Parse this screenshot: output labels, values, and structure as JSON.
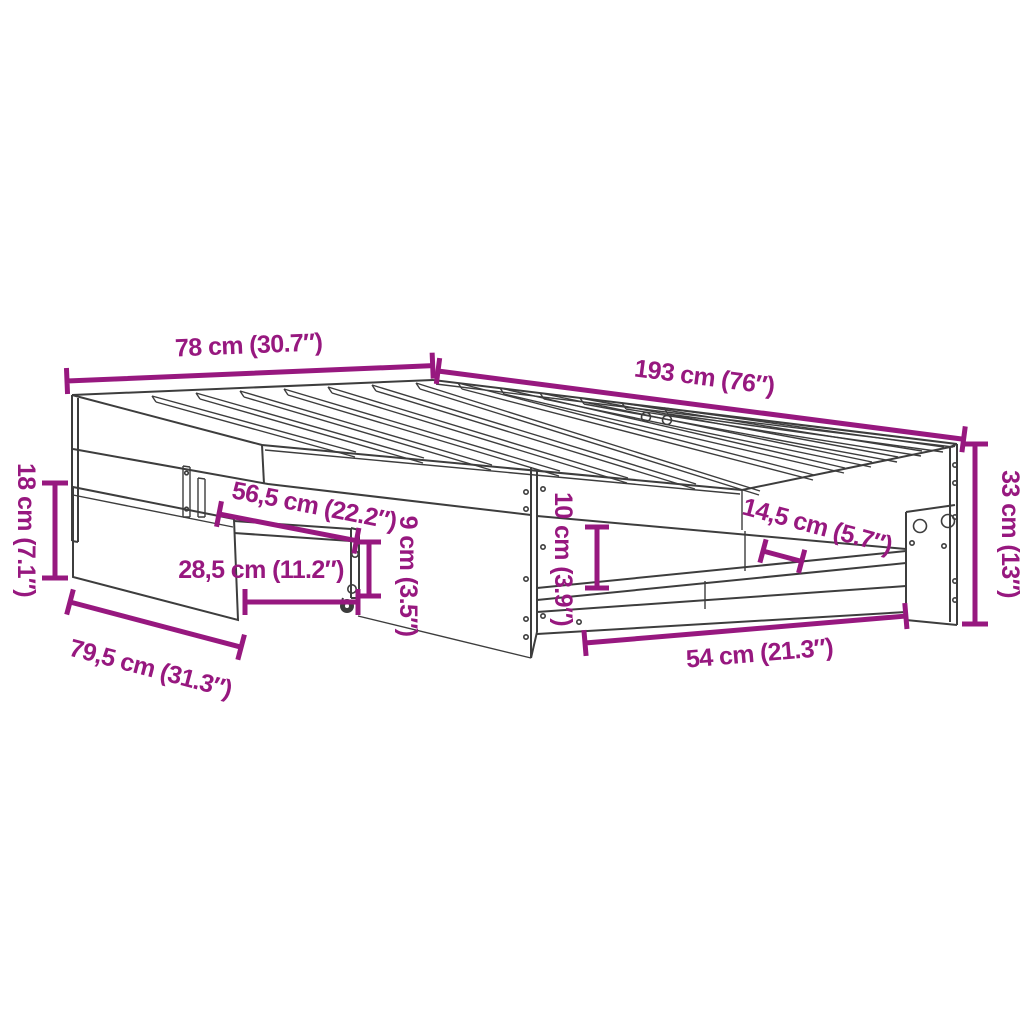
{
  "title": "Bed frame dimension diagram",
  "colors": {
    "dimension": "#97187f",
    "drawing": "#3d3d3d",
    "background": "#ffffff"
  },
  "dimensions": [
    {
      "id": "head-width",
      "label": "78 cm (30.7″)"
    },
    {
      "id": "frame-length",
      "label": "193 cm (76″)"
    },
    {
      "id": "frame-height",
      "label": "33 cm (13″)"
    },
    {
      "id": "pullout-panel-height",
      "label": "18 cm (7.1″)"
    },
    {
      "id": "pullout-depth",
      "label": "79,5 cm (31.3″)"
    },
    {
      "id": "pullout-rail-length",
      "label": "56,5 cm (22.2″)"
    },
    {
      "id": "pullout-front-width",
      "label": "28,5 cm (11.2″)"
    },
    {
      "id": "pullout-rail-height",
      "label": "9 cm (3.5″)"
    },
    {
      "id": "shelf-gap-height",
      "label": "10 cm (3.9″)"
    },
    {
      "id": "shelf-depth",
      "label": "14,5 cm (5.7″)"
    },
    {
      "id": "bottom-opening-width",
      "label": "54 cm (21.3″)"
    }
  ]
}
